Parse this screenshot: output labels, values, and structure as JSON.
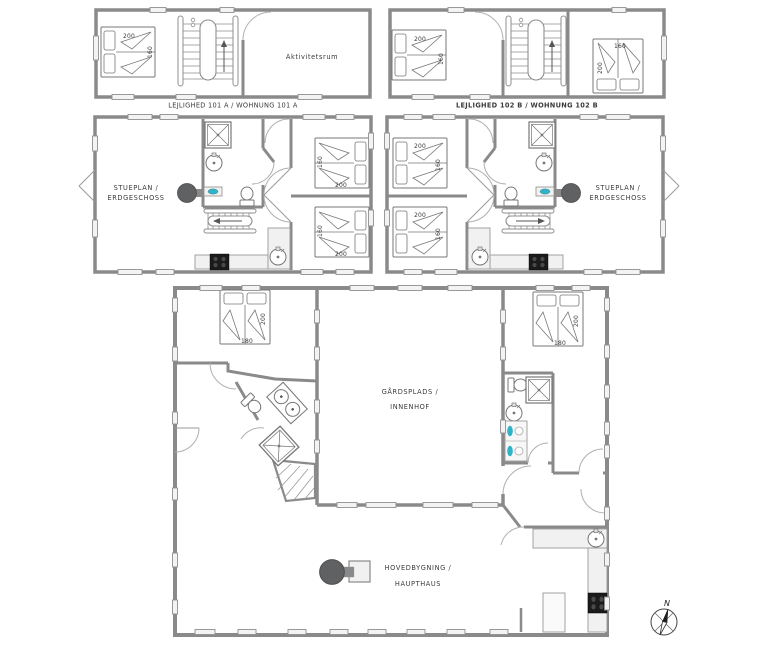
{
  "colors": {
    "wall": "#8a8a8a",
    "line": "#777777",
    "counter": "#f1f1f1",
    "teal": "#2fb3c6",
    "stove_dark": "#5f6163",
    "appliance_black": "#1b1b1b",
    "text": "#3a3a3a"
  },
  "upper_left": {
    "title": "LEJLIGHED 101 A / WOHNUNG 101 A",
    "room": "Aktivitetsrum",
    "bed": {
      "dim_h": "200",
      "dim_v": "160"
    }
  },
  "upper_right": {
    "title": "LEJLIGHED 102 B / WOHNUNG 102 B",
    "bed_left": {
      "dim_h": "200",
      "dim_v": "160"
    },
    "bed_right": {
      "dim_h": "160",
      "dim_v": "200"
    }
  },
  "ground_left": {
    "title_line1": "STUEPLAN /",
    "title_line2": "ERDGESCHOSS",
    "bed_top": {
      "dim_h": "200",
      "dim_v": "160"
    },
    "bed_bottom": {
      "dim_h": "200",
      "dim_v": "160"
    }
  },
  "ground_right": {
    "title_line1": "STUEPLAN /",
    "title_line2": "ERDGESCHOSS",
    "bed_top": {
      "dim_h": "200",
      "dim_v": "160"
    },
    "bed_bottom": {
      "dim_h": "200",
      "dim_v": "160"
    }
  },
  "main_house": {
    "courtyard_line1": "GÅRDSPLADS /",
    "courtyard_line2": "INNENHOF",
    "label_line1": "HOVEDBYGNING /",
    "label_line2": "HAUPTHAUS",
    "bed_left": {
      "dim_h": "180",
      "dim_v": "200"
    },
    "bed_right": {
      "dim_h": "180",
      "dim_v": "200"
    }
  },
  "compass": {
    "north_label": "N"
  }
}
